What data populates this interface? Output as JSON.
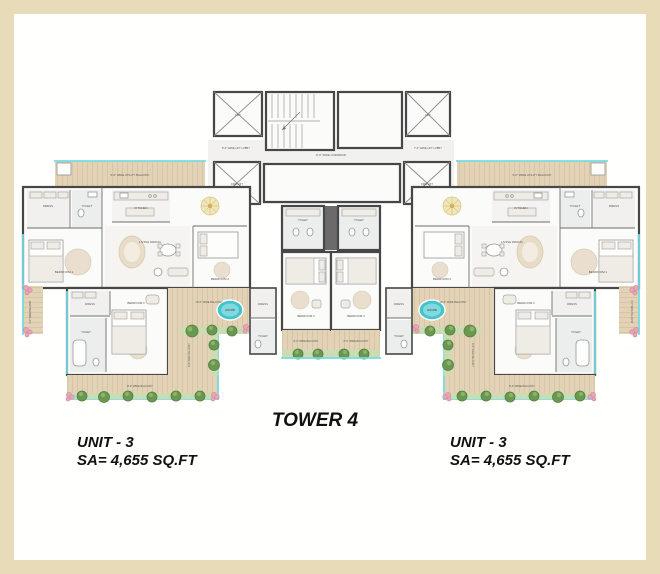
{
  "title": {
    "tower": "TOWER 4"
  },
  "units": {
    "left": {
      "name": "UNIT - 3",
      "area": "SA= 4,655 SQ.FT"
    },
    "right": {
      "name": "UNIT - 3",
      "area": "SA= 4,655 SQ.FT"
    }
  },
  "colors": {
    "frame_beige": "#e8dcb8",
    "canvas_white": "#fffffe",
    "wall_gray": "#474747",
    "deck_tan": "#e2d2b6",
    "hedge_green": "#ccdcb2",
    "bush_green": "#6a9850",
    "flower_pink": "#e9a6b6",
    "window_cyan": "#74dbe2",
    "jacuzzi_teal": "#45c3cb",
    "foyer_gold": "#f1e6ba"
  },
  "plan_labels": [
    {
      "t": "5'-0\" WIDE UTILITY BALCONY",
      "x": 130,
      "y": 176,
      "s": 2.8
    },
    {
      "t": "5'-0\" WIDE UTILITY BALCONY",
      "x": 532,
      "y": 176,
      "s": 2.8
    },
    {
      "t": "DRESS",
      "x": 48,
      "y": 207,
      "s": 3.0
    },
    {
      "t": "DRESS",
      "x": 614,
      "y": 207,
      "s": 3.0
    },
    {
      "t": "TOILET",
      "x": 87,
      "y": 207,
      "s": 3.0
    },
    {
      "t": "TOILET",
      "x": 575,
      "y": 207,
      "s": 3.0
    },
    {
      "t": "KITCHEN",
      "x": 141,
      "y": 209,
      "s": 3.0
    },
    {
      "t": "KITCHEN",
      "x": 521,
      "y": 209,
      "s": 3.0
    },
    {
      "t": "BEDROOM 1",
      "x": 64,
      "y": 273,
      "s": 3.1
    },
    {
      "t": "BEDROOM 1",
      "x": 598,
      "y": 273,
      "s": 3.1
    },
    {
      "t": "LIVING DINING",
      "x": 150,
      "y": 243,
      "s": 3.1
    },
    {
      "t": "LIVING DINING",
      "x": 512,
      "y": 243,
      "s": 3.1
    },
    {
      "t": "BEDROOM 2",
      "x": 220,
      "y": 280,
      "s": 3.0
    },
    {
      "t": "BEDROOM 2",
      "x": 442,
      "y": 280,
      "s": 3.0
    },
    {
      "t": "TOILET",
      "x": 303,
      "y": 221,
      "s": 2.8
    },
    {
      "t": "TOILET",
      "x": 359,
      "y": 221,
      "s": 2.8
    },
    {
      "t": "DRESS",
      "x": 263,
      "y": 305,
      "s": 2.8
    },
    {
      "t": "DRESS",
      "x": 399,
      "y": 305,
      "s": 2.8
    },
    {
      "t": "TOILET",
      "x": 263,
      "y": 337,
      "s": 2.8
    },
    {
      "t": "TOILET",
      "x": 399,
      "y": 337,
      "s": 2.8
    },
    {
      "t": "BEDROOM 4",
      "x": 306,
      "y": 317,
      "s": 2.9
    },
    {
      "t": "BEDROOM 4",
      "x": 356,
      "y": 317,
      "s": 2.9
    },
    {
      "t": "8'-0\" WIDE BALCONY",
      "x": 306,
      "y": 342,
      "s": 2.5
    },
    {
      "t": "8'-0\" WIDE BALCONY",
      "x": 356,
      "y": 342,
      "s": 2.5
    },
    {
      "t": "10'-0\" WIDE BALCONY",
      "x": 209,
      "y": 303,
      "s": 2.6
    },
    {
      "t": "10'-0\" WIDE BALCONY",
      "x": 453,
      "y": 303,
      "s": 2.6
    },
    {
      "t": "8'-0\" WIDE BALCONY",
      "x": 140,
      "y": 387,
      "s": 2.6
    },
    {
      "t": "8'-0\" WIDE BALCONY",
      "x": 522,
      "y": 387,
      "s": 2.6
    },
    {
      "t": "8'-0\" WIDE BALCONY",
      "x": 190,
      "y": 355,
      "s": 2.4,
      "r": -90
    },
    {
      "t": "8'-0\" WIDE BALCONY",
      "x": 472,
      "y": 355,
      "s": 2.4,
      "r": 90
    },
    {
      "t": "6'-0\" WIDE BALCONY",
      "x": 31,
      "y": 312,
      "s": 2.3,
      "r": -90
    },
    {
      "t": "6'-0\" WIDE BALCONY",
      "x": 631,
      "y": 312,
      "s": 2.3,
      "r": 90
    },
    {
      "t": "DRESS",
      "x": 90,
      "y": 305,
      "s": 2.8
    },
    {
      "t": "DRESS",
      "x": 572,
      "y": 305,
      "s": 2.8
    },
    {
      "t": "TOILET",
      "x": 86,
      "y": 333,
      "s": 2.8
    },
    {
      "t": "TOILET",
      "x": 576,
      "y": 333,
      "s": 2.8
    },
    {
      "t": "BEDROOM 3",
      "x": 136,
      "y": 304,
      "s": 2.9
    },
    {
      "t": "BEDROOM 3",
      "x": 526,
      "y": 304,
      "s": 2.9
    },
    {
      "t": "JACUZZI",
      "x": 230,
      "y": 311,
      "s": 2.4,
      "c": "#ffffff",
      "w": "bold"
    },
    {
      "t": "JACUZZI",
      "x": 432,
      "y": 311,
      "s": 2.4,
      "c": "#ffffff",
      "w": "bold"
    },
    {
      "t": "8'-0\" WIDE LIFT LOBBY",
      "x": 236,
      "y": 149,
      "s": 2.6
    },
    {
      "t": "7'-0\" WIDE LIFT LOBBY",
      "x": 428,
      "y": 149,
      "s": 2.6
    },
    {
      "t": "8'-0\" WIDE CORRIDOR",
      "x": 331,
      "y": 156,
      "s": 2.8
    },
    {
      "t": "LIFT",
      "x": 238,
      "y": 116,
      "s": 2.8
    },
    {
      "t": "LIFT",
      "x": 428,
      "y": 116,
      "s": 2.8
    },
    {
      "t": "FIRE LIFT",
      "x": 237,
      "y": 185,
      "s": 2.6
    },
    {
      "t": "FIRE LIFT",
      "x": 427,
      "y": 185,
      "s": 2.6
    }
  ]
}
